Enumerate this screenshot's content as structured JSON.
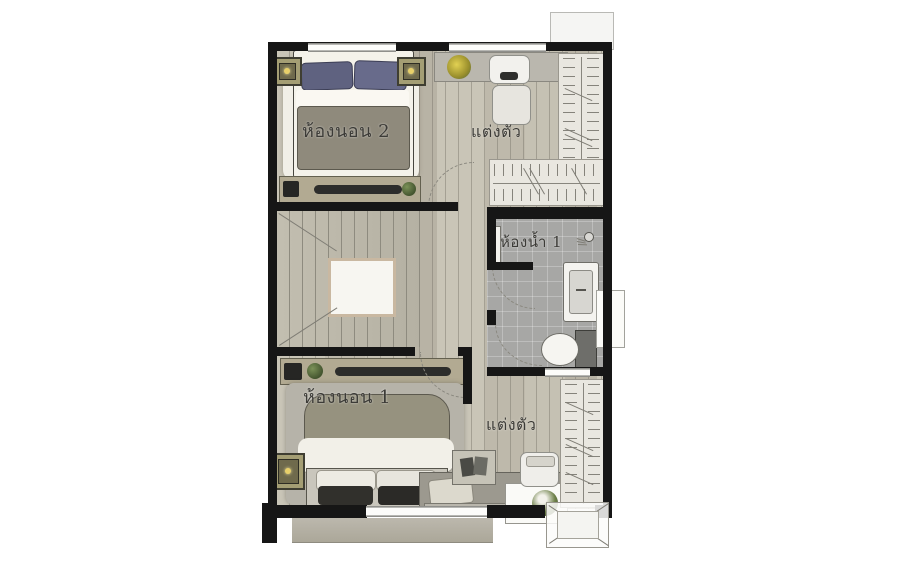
{
  "plan": {
    "type": "floor-plan",
    "floor": "second-floor-townhome",
    "language": "Thai"
  },
  "rooms": {
    "bedroom2": {
      "label": "ห้องนอน 2",
      "meaning": "Bedroom 2"
    },
    "dressing_top": {
      "label": "แต่งตัว",
      "meaning": "Dressing area"
    },
    "bathroom1": {
      "label": "ห้องน้ำ 1",
      "meaning": "Bathroom 1"
    },
    "bedroom1": {
      "label": "ห้องนอน 1",
      "meaning": "Bedroom 1"
    },
    "dressing_bottom": {
      "label": "แต่งตัว",
      "meaning": "Dressing area"
    }
  },
  "furniture": {
    "bedroom2": [
      "double-bed",
      "blue-pillows",
      "rug",
      "nightstand-lamp-left",
      "nightstand-lamp-right",
      "tv-console",
      "plant"
    ],
    "dressing_top": [
      "vanity-desk",
      "flower-vase",
      "chair",
      "ottoman",
      "wardrobe-hangers-right",
      "wardrobe-hangers-bottom"
    ],
    "bathroom1": [
      "shower",
      "sink",
      "toilet",
      "window"
    ],
    "bedroom1": [
      "double-bed",
      "rug",
      "nightstand-lamp",
      "tv-console",
      "plant",
      "bench-daybed",
      "book-table",
      "flower-table",
      "chair"
    ],
    "dressing_bottom": [
      "wardrobe-hangers-right",
      "ottoman"
    ],
    "hall": [
      "u-shaped-staircase",
      "stair-void"
    ],
    "outside": [
      "balcony-slab",
      "balcony-table",
      "roof-box"
    ]
  },
  "colors": {
    "wall": "#161616",
    "wood_floor": "#c3bfb1",
    "tile_floor": "#a7a7a5",
    "rug_light": "#f1efe7",
    "rug_gray": "#b5b2a8",
    "pillow_blue": "#5f6280",
    "blanket_gray": "#8f8a7c",
    "console_tan": "#b2aa92",
    "plant_green": "#55683a",
    "flower_yellow": "#d8c43a",
    "closet_bg": "#e9e7e0",
    "background": "#ffffff"
  }
}
